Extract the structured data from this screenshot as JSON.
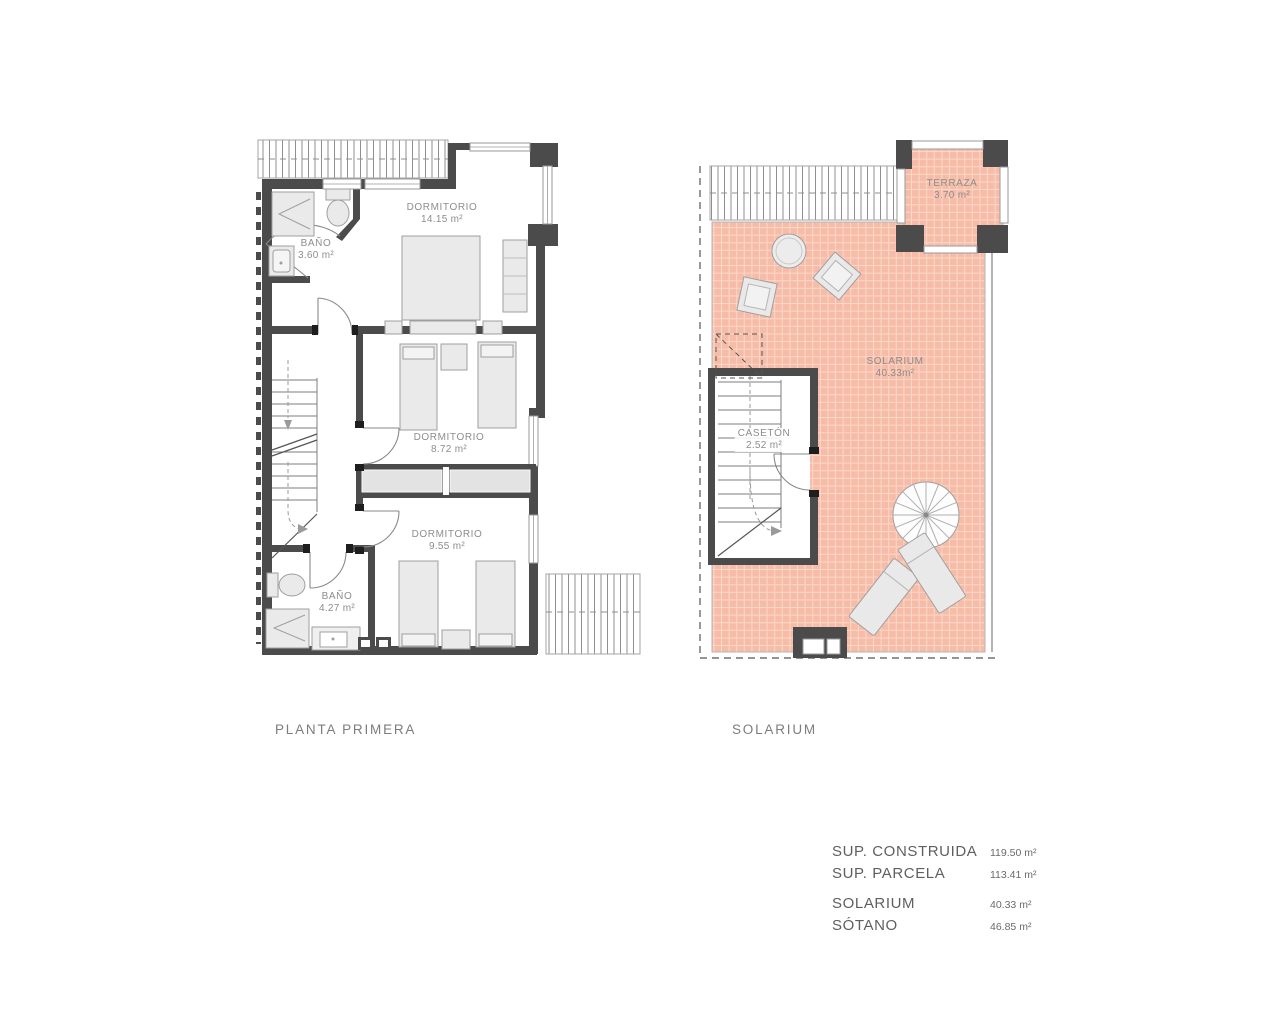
{
  "plans": {
    "planta_primera": {
      "title": "PLANTA PRIMERA",
      "rooms": [
        {
          "name": "BAÑO",
          "area": "3.60 m²"
        },
        {
          "name": "DORMITORIO",
          "area": "14.15 m²"
        },
        {
          "name": "DORMITORIO",
          "area": "8.72 m²"
        },
        {
          "name": "DORMITORIO",
          "area": "9.55 m²"
        },
        {
          "name": "BAÑO",
          "area": "4.27 m²"
        }
      ]
    },
    "solarium": {
      "title": "SOLARIUM",
      "rooms": [
        {
          "name": "TERRAZA",
          "area": "3.70 m²"
        },
        {
          "name": "SOLARIUM",
          "area": "40.33m²"
        },
        {
          "name": "CASETÓN",
          "area": "2.52 m²"
        }
      ]
    }
  },
  "summary": {
    "rows": [
      {
        "label": "SUP. CONSTRUIDA",
        "value": "119.50 m²"
      },
      {
        "label": "SUP. PARCELA",
        "value": "113.41 m²"
      },
      {
        "label": "SOLARIUM",
        "value": "40.33 m²"
      },
      {
        "label": "SÓTANO",
        "value": "46.85 m²"
      }
    ]
  },
  "colors": {
    "wall": "#4b4b4b",
    "tile": "#f7bca8",
    "tile_grid": "#fbd8ca",
    "furniture": "#eaeaea",
    "outline": "#9f9f9f",
    "room_label_text": "#8d8d8d",
    "title_text": "#7d7d7d",
    "summary_label_text": "#5f5f5f"
  }
}
